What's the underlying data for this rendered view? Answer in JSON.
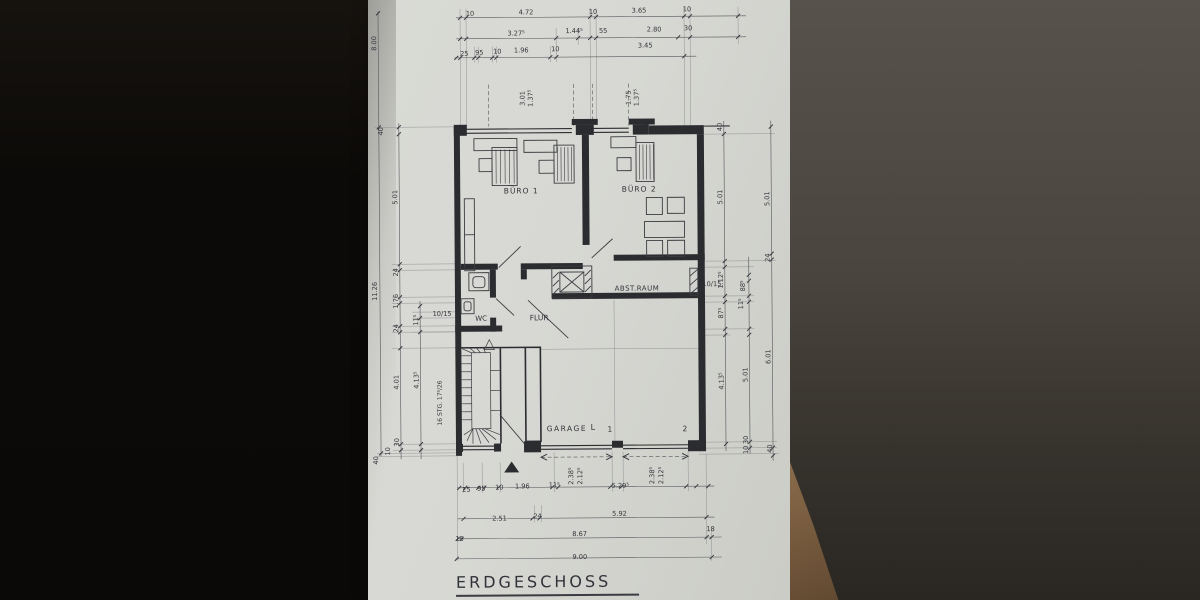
{
  "title": "ERDGESCHOSS",
  "colors": {
    "paper": "#d7d8d3",
    "ink": "#33343a",
    "wall_poche": "#2b2c30",
    "background_left": "#0c0a08",
    "background_right": "#57524b",
    "wood_corner": "#7a5f41"
  },
  "plan": {
    "labels": {
      "top_dims": [
        {
          "t": "10",
          "x": 104,
          "y": 15
        },
        {
          "t": "4.72",
          "x": 160,
          "y": 14
        },
        {
          "t": "10",
          "x": 227,
          "y": 14
        },
        {
          "t": "3.65",
          "x": 273,
          "y": 13
        },
        {
          "t": "10",
          "x": 321,
          "y": 12
        },
        {
          "t": "3.27⁵",
          "x": 150,
          "y": 35
        },
        {
          "t": "1.44⁵",
          "x": 208,
          "y": 33
        },
        {
          "t": "55",
          "x": 237,
          "y": 33
        },
        {
          "t": "2.80",
          "x": 288,
          "y": 32
        },
        {
          "t": "30",
          "x": 322,
          "y": 31
        },
        {
          "t": "25",
          "x": 98,
          "y": 55
        },
        {
          "t": "95",
          "x": 113,
          "y": 54
        },
        {
          "t": "10",
          "x": 131,
          "y": 53
        },
        {
          "t": "1.96",
          "x": 155,
          "y": 52
        },
        {
          "t": "10",
          "x": 189,
          "y": 51
        },
        {
          "t": "3.45",
          "x": 279,
          "y": 48
        },
        {
          "t": "8.00",
          "x": 10,
          "y": 42,
          "r": -90
        }
      ],
      "window_dims": [
        {
          "t": "3.01",
          "x": 158,
          "y": 98,
          "r": -90
        },
        {
          "t": "1.37⁵",
          "x": 166,
          "y": 98,
          "r": -90
        },
        {
          "t": "1.75",
          "x": 264,
          "y": 98,
          "r": -90
        },
        {
          "t": "1.37⁵",
          "x": 272,
          "y": 98,
          "r": -90
        }
      ],
      "left_dims": [
        {
          "t": "40",
          "x": 16,
          "y": 130,
          "r": -90
        },
        {
          "t": "5.01",
          "x": 30,
          "y": 196,
          "r": -90
        },
        {
          "t": "11.26",
          "x": 9,
          "y": 290,
          "r": -90
        },
        {
          "t": "24",
          "x": 30,
          "y": 271,
          "r": -90
        },
        {
          "t": "1.76",
          "x": 30,
          "y": 300,
          "r": -90
        },
        {
          "t": "24",
          "x": 30,
          "y": 327,
          "r": -90
        },
        {
          "t": "11⁵",
          "x": 50,
          "y": 319,
          "r": -90
        },
        {
          "t": "10/15",
          "x": 74,
          "y": 315
        },
        {
          "t": "4.01",
          "x": 30,
          "y": 381,
          "r": -90
        },
        {
          "t": "4.13⁵",
          "x": 50,
          "y": 379,
          "r": -90
        },
        {
          "t": "16 STG. 17⁸/26",
          "x": 73,
          "y": 402,
          "r": -90,
          "s": 6
        },
        {
          "t": "30",
          "x": 30,
          "y": 441,
          "r": -90
        },
        {
          "t": "10",
          "x": 21,
          "y": 450,
          "r": -90
        },
        {
          "t": "40",
          "x": 9,
          "y": 459,
          "r": -90
        }
      ],
      "right_dims": [
        {
          "t": "40",
          "x": 355,
          "y": 128,
          "r": -90
        },
        {
          "t": "5.01",
          "x": 355,
          "y": 198,
          "r": -90
        },
        {
          "t": "5.01",
          "x": 402,
          "y": 200,
          "r": -90
        },
        {
          "t": "24",
          "x": 402,
          "y": 259,
          "r": -90
        },
        {
          "t": "10/15",
          "x": 344,
          "y": 287
        },
        {
          "t": "1.12⁵",
          "x": 355,
          "y": 281,
          "r": -90
        },
        {
          "t": "88⁵",
          "x": 377,
          "y": 287,
          "r": -90
        },
        {
          "t": "87⁵",
          "x": 355,
          "y": 314,
          "r": -90
        },
        {
          "t": "11⁵",
          "x": 375,
          "y": 305,
          "r": -90
        },
        {
          "t": "4.13⁵",
          "x": 355,
          "y": 382,
          "r": -90
        },
        {
          "t": "5.01",
          "x": 379,
          "y": 376,
          "r": -90
        },
        {
          "t": "6.01",
          "x": 402,
          "y": 358,
          "r": -90
        },
        {
          "t": "30",
          "x": 379,
          "y": 441,
          "r": -90
        },
        {
          "t": "10",
          "x": 379,
          "y": 451,
          "r": -90
        },
        {
          "t": "40",
          "x": 403,
          "y": 450,
          "r": -90
        }
      ],
      "room_labels": [
        {
          "t": "BÜRO 1",
          "x": 154,
          "y": 193,
          "s": 7.5,
          "ls": 1
        },
        {
          "t": "BÜRO 2",
          "x": 272,
          "y": 192,
          "s": 7.5,
          "ls": 1
        },
        {
          "t": "WC",
          "x": 113,
          "y": 320,
          "s": 7
        },
        {
          "t": "FLUR",
          "x": 171,
          "y": 320,
          "s": 7.5
        },
        {
          "t": "ABST.RAUM",
          "x": 269,
          "y": 291,
          "s": 7,
          "ls": 0.5
        },
        {
          "t": "GARAGE",
          "x": 198,
          "y": 431,
          "s": 7.5,
          "ls": 1.5
        }
      ],
      "garage_labels": [
        {
          "t": "L",
          "x": 224,
          "y": 430,
          "s": 8
        },
        {
          "t": "1",
          "x": 241,
          "y": 432,
          "s": 7.5
        },
        {
          "t": "2",
          "x": 316,
          "y": 432,
          "s": 7.5
        }
      ],
      "garage_dims": [
        {
          "t": "2.38⁵",
          "x": 204,
          "y": 476,
          "r": -90
        },
        {
          "t": "2.12⁵",
          "x": 213,
          "y": 476,
          "r": -90
        },
        {
          "t": "5.29⁵",
          "x": 251,
          "y": 488
        },
        {
          "t": "2.38⁵",
          "x": 285,
          "y": 476,
          "r": -90
        },
        {
          "t": "2.12⁵",
          "x": 294,
          "y": 476,
          "r": -90
        }
      ],
      "bottom_dims": [
        {
          "t": "25",
          "x": 97,
          "y": 491
        },
        {
          "t": "95",
          "x": 112,
          "y": 490
        },
        {
          "t": "10",
          "x": 130,
          "y": 489
        },
        {
          "t": "1.96",
          "x": 153,
          "y": 488
        },
        {
          "t": "11⁵",
          "x": 185,
          "y": 487
        },
        {
          "t": "2.51",
          "x": 130,
          "y": 520
        },
        {
          "t": "24",
          "x": 168,
          "y": 518
        },
        {
          "t": "5.92",
          "x": 250,
          "y": 516
        },
        {
          "t": "15",
          "x": 90,
          "y": 540
        },
        {
          "t": "8.67",
          "x": 210,
          "y": 536
        },
        {
          "t": "18",
          "x": 341,
          "y": 532
        },
        {
          "t": "9.00",
          "x": 210,
          "y": 559
        }
      ]
    }
  }
}
